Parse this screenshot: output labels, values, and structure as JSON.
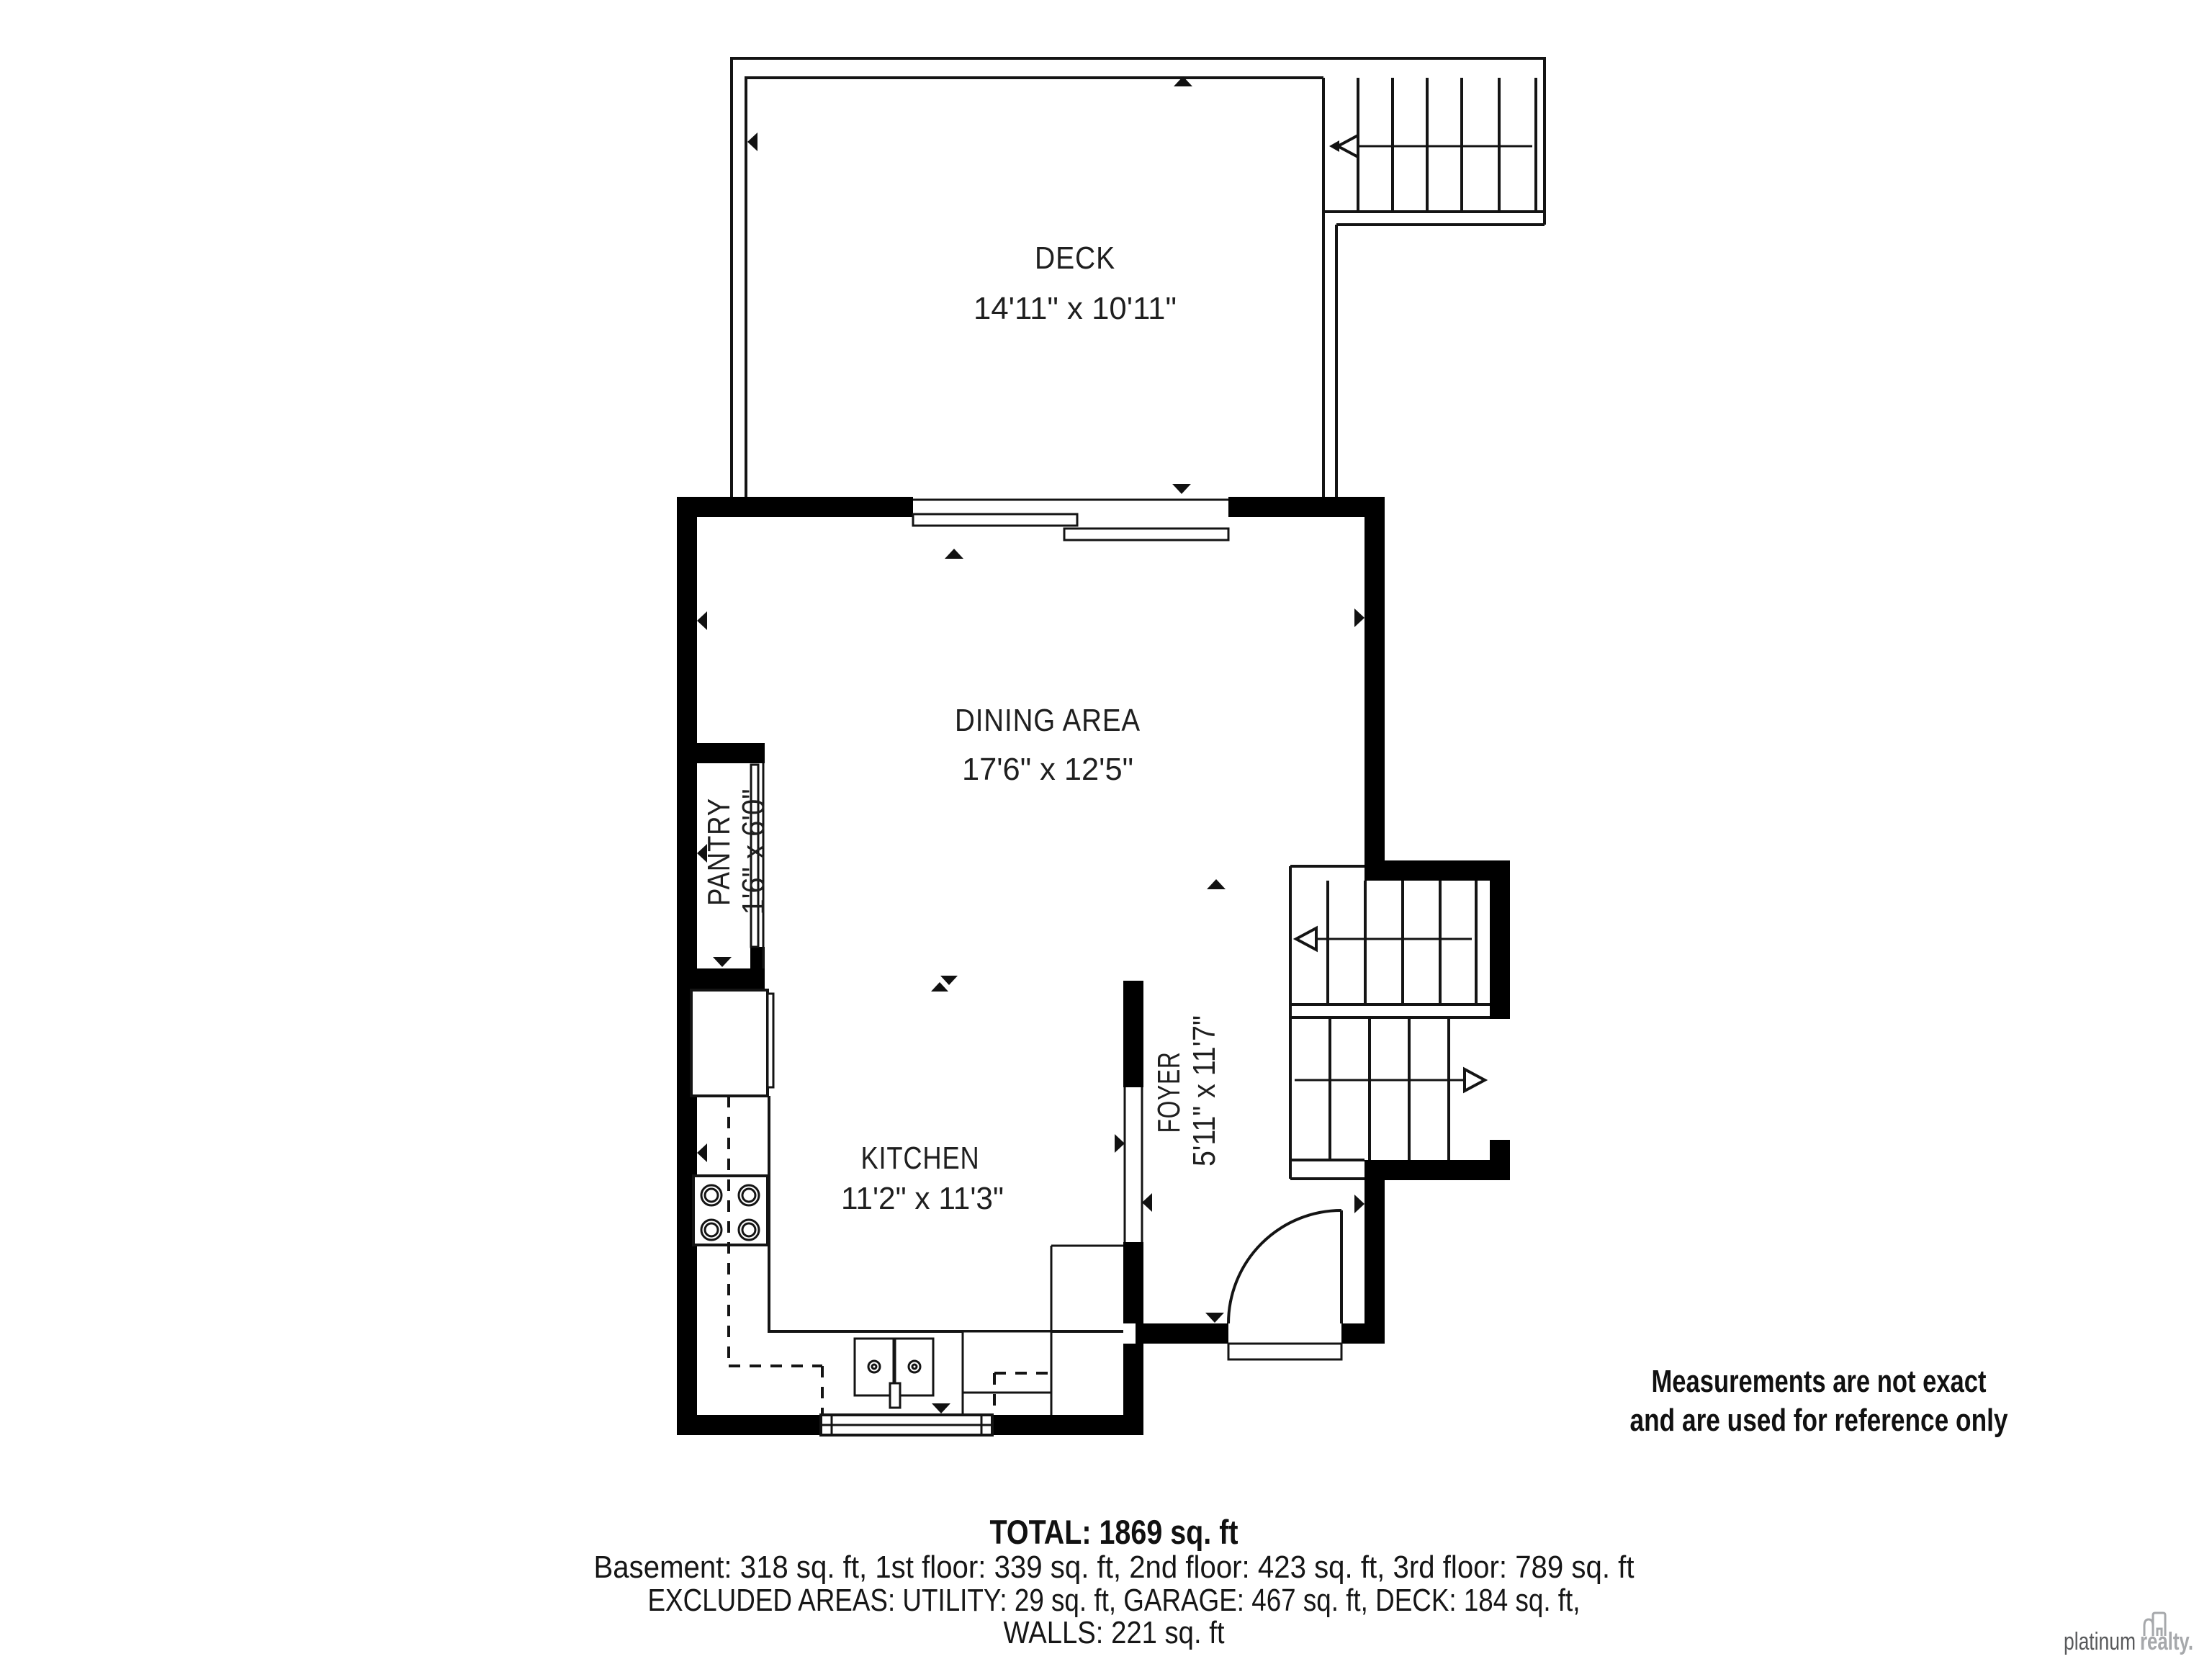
{
  "rooms": {
    "deck": {
      "name": "DECK",
      "dims": "14'11\" x 10'11\""
    },
    "dining": {
      "name": "DINING AREA",
      "dims": "17'6\" x 12'5\""
    },
    "pantry": {
      "name": "PANTRY",
      "dims": "1'6\" x 6'0\""
    },
    "kitchen": {
      "name": "KITCHEN",
      "dims": "11'2\" x 11'3\""
    },
    "foyer": {
      "name": "FOYER",
      "dims": "5'11\" x 11'7\""
    }
  },
  "disclaimer": {
    "line1": "Measurements are not exact",
    "line2": "and are used for reference only"
  },
  "summary": {
    "total": "TOTAL: 1869 sq. ft",
    "floors": "Basement: 318 sq. ft, 1st floor: 339 sq. ft, 2nd floor: 423 sq. ft, 3rd floor: 789 sq. ft",
    "excluded": "EXCLUDED AREAS: UTILITY: 29 sq. ft, GARAGE: 467 sq. ft, DECK: 184 sq. ft,",
    "walls": "WALLS: 221 sq. ft"
  },
  "brand": {
    "word1": "platinum",
    "word2": "realty."
  },
  "colors": {
    "wall": "#000000",
    "line": "#141414",
    "brand_dark": "#58595b",
    "brand_light": "#a6a8ab"
  }
}
